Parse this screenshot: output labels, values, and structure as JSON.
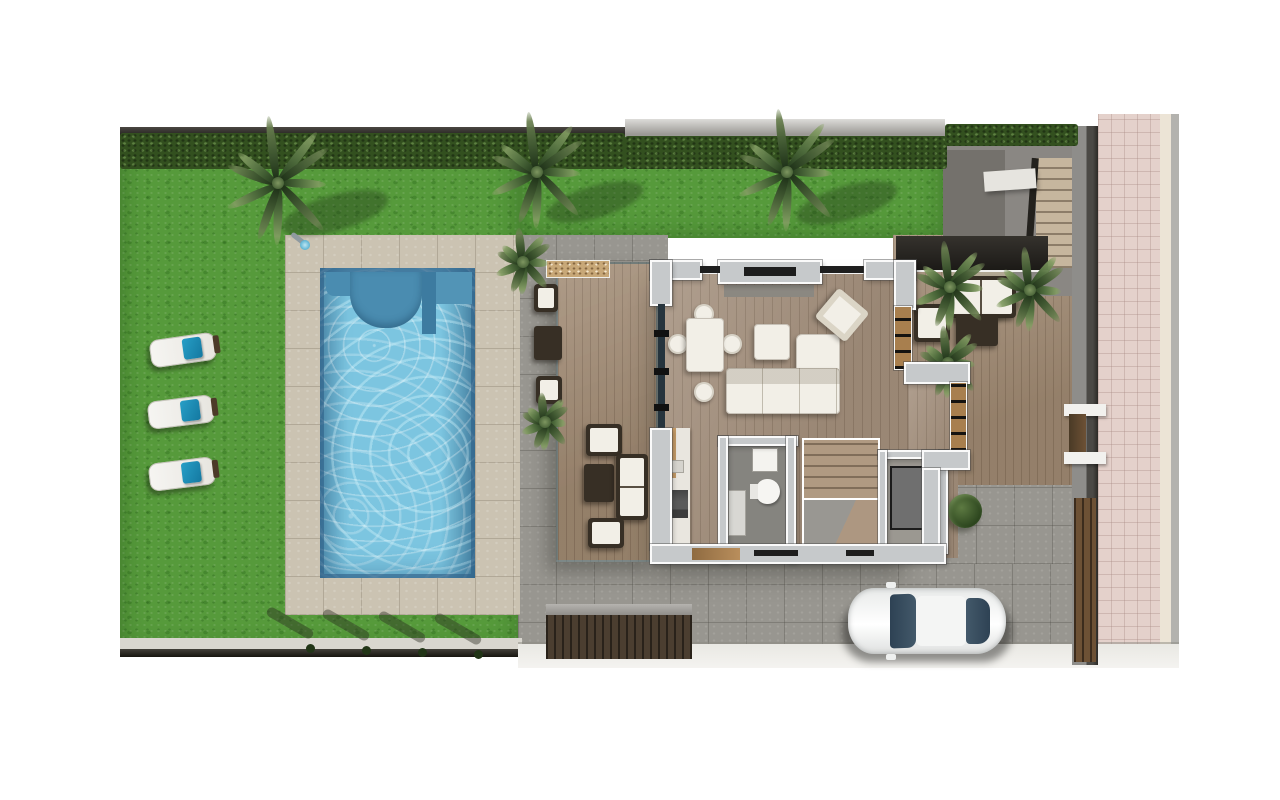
{
  "scene": {
    "kind": "architectural-floor-plan-render",
    "view": "top-down",
    "areas": [
      {
        "name": "lawn",
        "description_icon": "grass-area"
      },
      {
        "name": "swimming-pool",
        "description_icon": "pool-water"
      },
      {
        "name": "pool-deck",
        "description_icon": "tiled-deck"
      },
      {
        "name": "covered-terrace-left",
        "description_icon": "wood-deck"
      },
      {
        "name": "side-terrace-right",
        "description_icon": "wood-deck"
      },
      {
        "name": "living-dining-room",
        "description_icon": "wood-floor"
      },
      {
        "name": "kitchen",
        "description_icon": "counter"
      },
      {
        "name": "bathroom",
        "description_icon": "toilet"
      },
      {
        "name": "interior-staircase",
        "description_icon": "stairs"
      },
      {
        "name": "exterior-staircase",
        "description_icon": "stairs"
      },
      {
        "name": "driveway",
        "description_icon": "paving"
      },
      {
        "name": "street",
        "description_icon": "pink-paving"
      }
    ],
    "objects": {
      "sun_loungers": 3,
      "lounger_towels": 3,
      "large_palm_trees": 3,
      "small_palms": 5,
      "dining_chairs": 4,
      "sofas": 3,
      "armchairs": 6,
      "coffee_tables": 3,
      "car": 1,
      "gates": 2,
      "toilet": 1,
      "fireplace": 1,
      "bbq_counter": 1,
      "garden_bush": 1,
      "outdoor_shower": 1,
      "edge_planters": 4
    }
  },
  "palette": {
    "grass": "#569a3b",
    "hedge": "#33501f",
    "deck": "#cbc3b2",
    "pave": "#989690",
    "pave_dark": "#87857f",
    "wood_terrace": "#a5907a",
    "wood_floor": "#a79482",
    "pool_water": "#7cc5e0",
    "pool_bench": "#4a8cb0",
    "pool_edge": "#2e6e96",
    "wall_fill": "#c6c9cb",
    "wall_outline": "#fafafa",
    "window_wood": "#a87f4e",
    "glass": "#26343d",
    "road_pink": "#e4d1cb",
    "curb": "#ece4d6",
    "street_edge": "#b3b2ae",
    "fence_dark": "#2c2a26",
    "gate_wood": "#6d5135",
    "towel": "#279fc7",
    "car_body": "#f4f5f4",
    "car_glass": "#43596a",
    "ramp": "#4b3e30",
    "stair_tread": "#c6b69e",
    "furniture_white": "#f2efe7",
    "furniture_dark": "#372f25",
    "stone_counter": "#c8a878",
    "sidewalk": "#e9e8e3",
    "fireplace_slot": "#1d1d1d"
  }
}
